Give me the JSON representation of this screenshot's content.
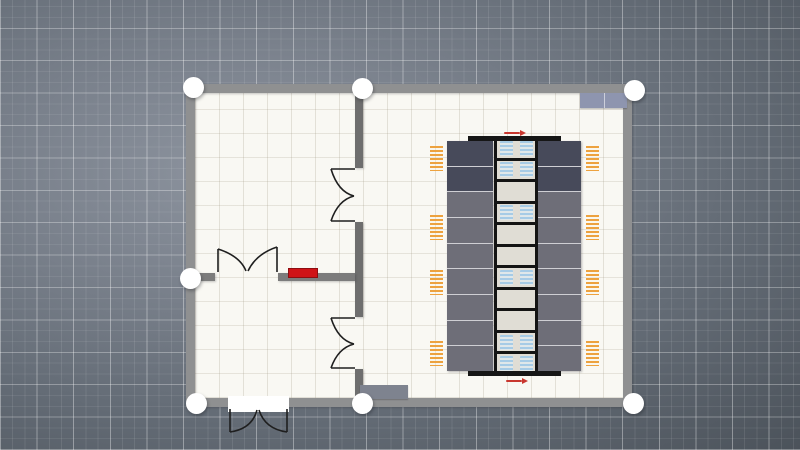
{
  "canvas": {
    "width": 800,
    "height": 450
  },
  "palette": {
    "background_base": "#7b828d",
    "background_dark": "#4b525a",
    "grid_line": "#ffffff",
    "floor": "#f9f8f3",
    "floor_grid": "#a09884",
    "outer_wall": "#8f9091",
    "inner_wall_vertical": "#6e6e6e",
    "inner_wall_horizontal": "#7c7c7c",
    "handle": "#ffffff",
    "door_stroke": "#1f1f1f",
    "rack_dark": "#474a5a",
    "rack_medium": "#6e6e78",
    "rack_gap": "#cfcfd4",
    "aisle_frame": "#141414",
    "aisle_tile": "#e0ddd5",
    "vent_blue": "#a6cbe6",
    "cable_tray_orange": "#eda23f",
    "crac_top": "#8e95af",
    "crac_bottom": "#7e838f",
    "red_table": "#cf1317",
    "red_table_border": "#8e0d10",
    "flow_arrow_red": "#c9372f",
    "rack_bar_black": "#161616"
  },
  "scene": {
    "floor": {
      "x": 195,
      "y": 93,
      "w": 428,
      "h": 305
    },
    "walls": [
      {
        "id": "wall-outer-top",
        "x": 186,
        "y": 84,
        "w": 446,
        "h": 9,
        "color": "#8f9091"
      },
      {
        "id": "wall-outer-bottom",
        "x": 186,
        "y": 398,
        "w": 446,
        "h": 9,
        "color": "#8f9091"
      },
      {
        "id": "wall-outer-left",
        "x": 186,
        "y": 84,
        "w": 9,
        "h": 323,
        "color": "#8f9091"
      },
      {
        "id": "wall-outer-right",
        "x": 623,
        "y": 84,
        "w": 9,
        "h": 323,
        "color": "#8f9091"
      },
      {
        "id": "wall-inner-vertical-a",
        "x": 355,
        "y": 93,
        "w": 8,
        "h": 75,
        "color": "#6e6e6e"
      },
      {
        "id": "wall-inner-vertical-b",
        "x": 355,
        "y": 222,
        "w": 8,
        "h": 95,
        "color": "#6e6e6e"
      },
      {
        "id": "wall-inner-vertical-c",
        "x": 355,
        "y": 369,
        "w": 8,
        "h": 29,
        "color": "#6e6e6e"
      },
      {
        "id": "wall-inner-horizontal-a",
        "x": 195,
        "y": 273,
        "w": 20,
        "h": 8,
        "color": "#7c7c7c"
      },
      {
        "id": "wall-inner-horizontal-b",
        "x": 278,
        "y": 273,
        "w": 77,
        "h": 8,
        "color": "#7c7c7c"
      }
    ],
    "exterior_door_threshold": {
      "x": 228,
      "y": 396,
      "w": 61,
      "h": 16
    },
    "doors": [
      {
        "id": "double-door-upper-divider",
        "path": "M355 169 H331 M355 221 H331 M331 169 Q338 192 354 196 M331 221 Q338 200 354 196"
      },
      {
        "id": "double-door-inner-rooms",
        "path": "M218 272 V249 M277 272 V247 M218 249 Q240 256 246 271 M277 247 Q256 254 248 271"
      },
      {
        "id": "double-door-lower-divider",
        "path": "M355 318 H331 M355 368 H331 M331 318 Q338 340 354 344 M331 368 Q338 348 354 344"
      },
      {
        "id": "double-door-exterior",
        "path": "M230 409 V432 M287 409 V432 M230 432 Q252 429 257 410 M287 432 Q265 429 259 410"
      }
    ],
    "handles": [
      {
        "id": "handle-top-left",
        "cx": 193,
        "cy": 87
      },
      {
        "id": "handle-top-middle",
        "cx": 362,
        "cy": 88
      },
      {
        "id": "handle-top-right",
        "cx": 634,
        "cy": 90
      },
      {
        "id": "handle-middle-left",
        "cx": 190,
        "cy": 278
      },
      {
        "id": "handle-bottom-left",
        "cx": 196,
        "cy": 403
      },
      {
        "id": "handle-bottom-middle",
        "cx": 362,
        "cy": 403
      },
      {
        "id": "handle-bottom-right",
        "cx": 633,
        "cy": 403
      }
    ],
    "handle_diameter": 21,
    "crac_units": [
      {
        "id": "crac-unit-top-right",
        "x": 580,
        "y": 93,
        "w": 47,
        "h": 15,
        "color": "#8e95af",
        "divided": true
      },
      {
        "id": "crac-unit-bottom-left",
        "x": 360,
        "y": 385,
        "w": 48,
        "h": 14,
        "color": "#7e838f",
        "divided": false
      }
    ],
    "red_table": {
      "x": 288,
      "y": 268,
      "w": 30,
      "h": 10
    },
    "rack_row": {
      "bars": [
        {
          "id": "rack-row-top-rail",
          "x": 468,
          "y": 136,
          "w": 93,
          "h": 5
        },
        {
          "id": "rack-row-bottom-rail",
          "x": 468,
          "y": 371,
          "w": 93,
          "h": 5
        }
      ],
      "flow_arrows": [
        {
          "id": "airflow-arrow-top",
          "x": 504,
          "y": 130
        },
        {
          "id": "airflow-arrow-bottom",
          "x": 506,
          "y": 378
        }
      ],
      "columns": [
        {
          "id": "rack-column-left",
          "x": 447,
          "y": 141,
          "w": 46,
          "h": 230
        },
        {
          "id": "rack-column-right",
          "x": 538,
          "y": 141,
          "w": 43,
          "h": 230
        }
      ],
      "cells_per_column": 9,
      "dark_cells": 2,
      "aisle": {
        "x": 494,
        "y": 136,
        "w": 44,
        "h": 240,
        "tiles": 11,
        "vents": [
          true,
          true,
          false,
          true,
          false,
          false,
          true,
          false,
          false,
          true,
          true
        ]
      },
      "cable_trays": {
        "left_x": 430,
        "right_x": 586,
        "w": 13,
        "h": 25,
        "ys": [
          146,
          215,
          270,
          341
        ]
      }
    }
  }
}
